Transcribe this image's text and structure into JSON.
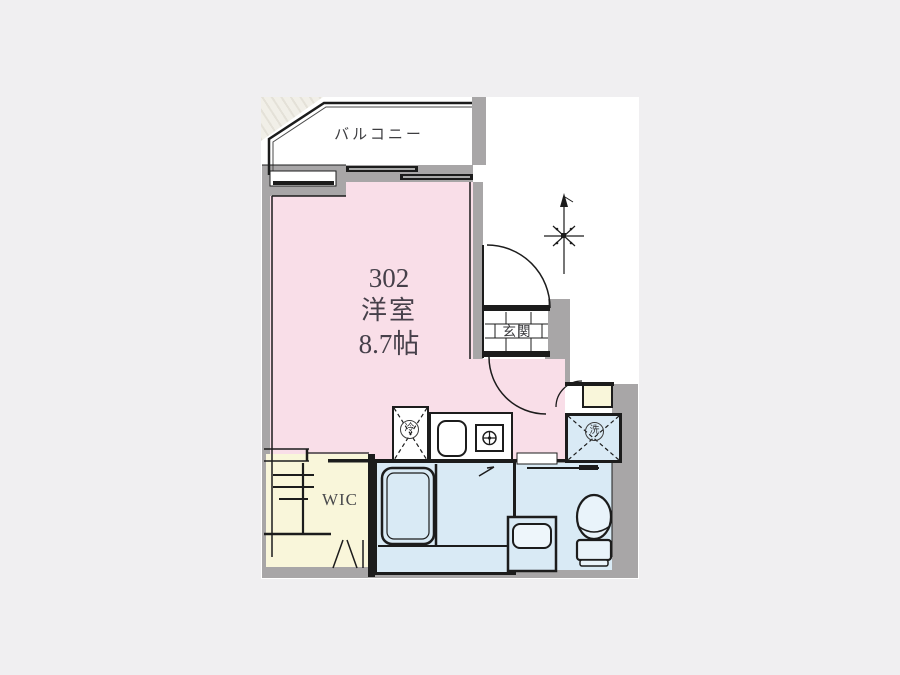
{
  "plan": {
    "balcony": {
      "label": "バルコニー"
    },
    "room": {
      "unit_number": "302",
      "type": "洋室",
      "size": "8.7帖"
    },
    "entrance": {
      "label": "玄関"
    },
    "wic": {
      "label": "WIC"
    },
    "kitchen": {
      "refrigerator_label": "冷",
      "washer_label": "洗"
    },
    "compass": {
      "icon": "north-arrow"
    },
    "colors": {
      "page_background": "#f0eff1",
      "room_pink": "#f9dee8",
      "closet_cream": "#f9f6da",
      "wet_area_blue": "#d9eaf5",
      "wall_gray": "#a8a6a7",
      "line_black": "#1c1c1c"
    }
  }
}
